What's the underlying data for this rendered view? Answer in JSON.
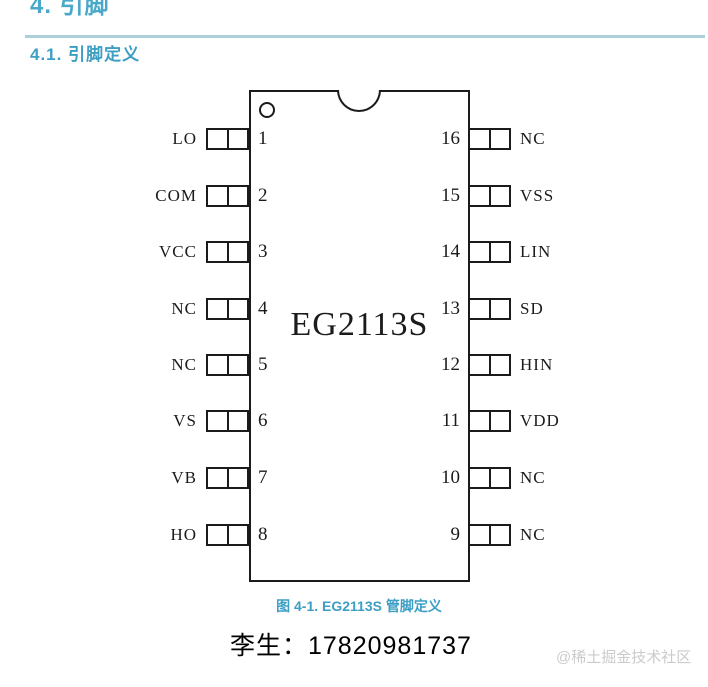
{
  "page": {
    "section_title": "4. 引脚",
    "subsection_title": "4.1. 引脚定义",
    "figure_caption": "图 4-1. EG2113S 管脚定义",
    "contact": "李生：17820981737",
    "watermark": "@稀土掘金技术社区"
  },
  "chip": {
    "part_number": "EG2113S",
    "left_pins": [
      {
        "number": "1",
        "label": "LO"
      },
      {
        "number": "2",
        "label": "COM"
      },
      {
        "number": "3",
        "label": "VCC"
      },
      {
        "number": "4",
        "label": "NC"
      },
      {
        "number": "5",
        "label": "NC"
      },
      {
        "number": "6",
        "label": "VS"
      },
      {
        "number": "7",
        "label": "VB"
      },
      {
        "number": "8",
        "label": "HO"
      }
    ],
    "right_pins": [
      {
        "number": "16",
        "label": "NC"
      },
      {
        "number": "15",
        "label": "VSS"
      },
      {
        "number": "14",
        "label": "LIN"
      },
      {
        "number": "13",
        "label": "SD"
      },
      {
        "number": "12",
        "label": "HIN"
      },
      {
        "number": "11",
        "label": "VDD"
      },
      {
        "number": "10",
        "label": "NC"
      },
      {
        "number": "9",
        "label": "NC"
      }
    ]
  },
  "colors": {
    "heading": "#4AA9C9",
    "subheading": "#3D9EC4",
    "caption": "#3D9EC4",
    "divider": "#ABD0DA",
    "watermark": "#CBCBCB",
    "line": "#1B1B1B"
  }
}
